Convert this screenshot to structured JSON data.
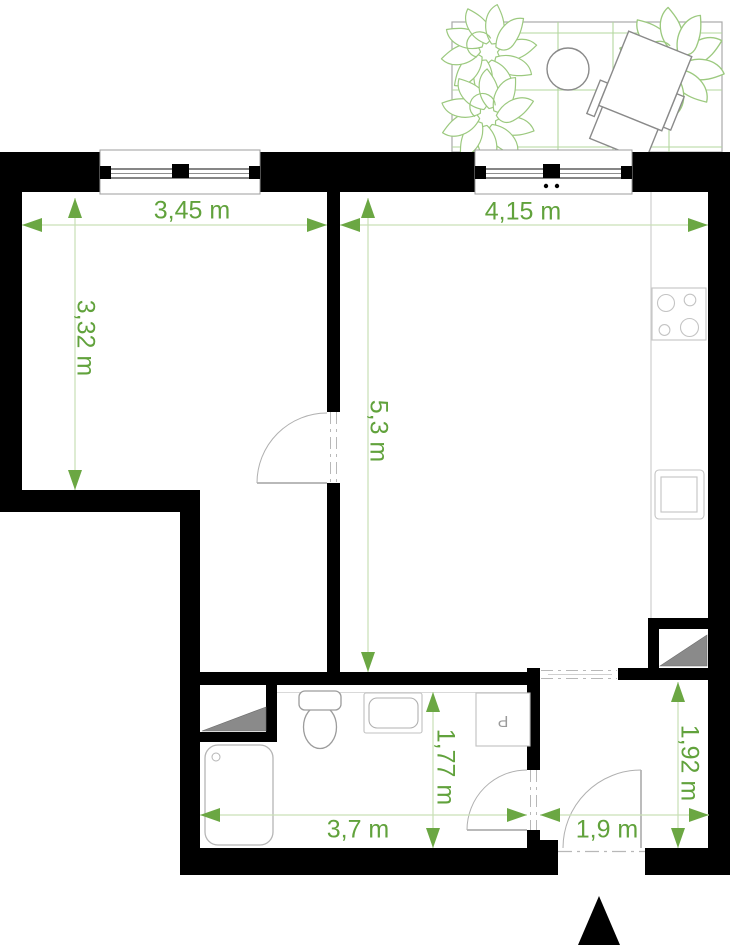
{
  "plan": {
    "type": "apartment-floor-plan",
    "units": "m",
    "dimensions": {
      "room_left_width": "3,45 m",
      "room_left_depth": "3,32 m",
      "living_width": "4,15 m",
      "living_depth": "5,3 m",
      "bathroom_width": "3,7 m",
      "bathroom_depth": "1,77 m",
      "hall_width": "1,9 m",
      "hall_depth": "1,92 m"
    },
    "appliance_labels": {
      "washing_machine": "P"
    },
    "colors": {
      "wall": "#000000",
      "dimension_green": "#61a23c",
      "dimension_line": "#c9e0b6",
      "balcony_grid_green": "#b3d79e",
      "plant_green": "#9cc97f",
      "fixture_gray": "#bcbcbc",
      "shaft_gray": "#8a8a8a"
    }
  }
}
